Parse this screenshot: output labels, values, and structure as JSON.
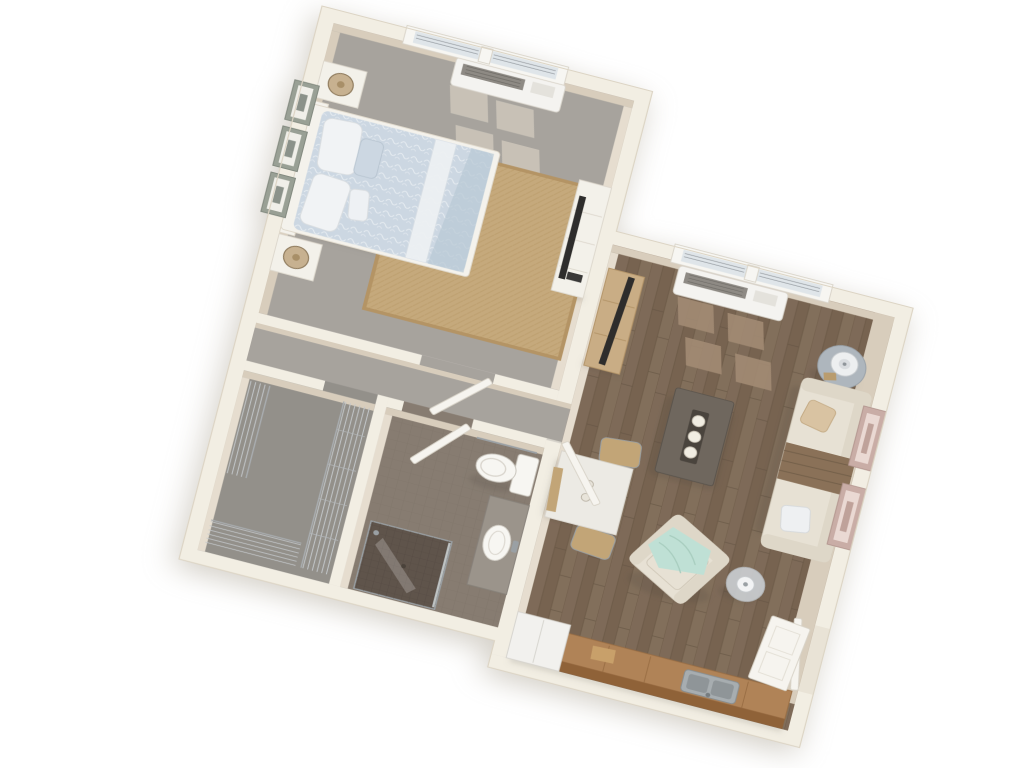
{
  "scene": {
    "description": "3D bird's-eye dollhouse rendering of a one-bedroom apartment floor plan on a white background, rotated clockwise about 15 degrees",
    "view": "top-down 3D render",
    "rotation_deg": 14.5
  },
  "colors": {
    "background": "#ffffff",
    "wall": "#f2eee3",
    "wall_outline": "#dcd4c4",
    "wall_face": "#d8cdbc",
    "wall_face_light": "#e6ddcf",
    "carpet": "#a7a39d",
    "carpet_sun": "#c9c3b8",
    "carpet_closet": "#93908a",
    "wood": "#7e6a58",
    "wood_dark": "#725e4c",
    "wood_sun": "#a28b73",
    "tile": "#877c71",
    "tile_line": "#776d62",
    "shower_tile": "#5f544b",
    "rug": "#c5a97c",
    "rug_border": "#b49465",
    "duvet": "#ccd7e2",
    "duvet_fold": "#eef1f4",
    "bedframe": "#f4f2ec",
    "pillow": "#f1f3f5",
    "nightstand": "#f3f1ea",
    "lamp_tan": "#c7b190",
    "art_frame": "#99a095",
    "art_mat": "#f0efe9",
    "art_frame_pink": "#c9ada6",
    "tv_black": "#2e2d2c",
    "console_wood": "#c9ad85",
    "side_table": "#aeb6bd",
    "lamp_shade": "#edeff0",
    "sofa": "#e7e1d4",
    "sofa_trim": "#ded7c8",
    "throw_brown": "#8a7158",
    "throw_mint": "#bfe0d5",
    "coffee_table": "#6f675e",
    "candle": "#f1ede2",
    "dining_table": "#eceae4",
    "chair_wood": "#c2a577",
    "counter_wood": "#b08357",
    "cabinet_wood": "#8f6238",
    "sink_metal": "#a7adb0",
    "appliance_white": "#f2f1ee",
    "door_white": "#f6f4ef",
    "porcelain": "#f7f6f2",
    "vanity_grey": "#9b948b",
    "chrome": "#9aa0a4"
  },
  "rooms": [
    {
      "id": "bedroom",
      "label": "Bedroom",
      "floor": "gray carpet",
      "items": [
        "queen bed with light blue patterned duvet",
        "two white nightstands with tan drum lamps",
        "three picture frames above headboard",
        "jute area rug",
        "white dresser with flat-screen TV",
        "wall air-conditioning unit under window",
        "double window with blinds",
        "door to hallway"
      ]
    },
    {
      "id": "living-room",
      "label": "Living Room",
      "floor": "brown hardwood planks",
      "items": [
        "cream sofa with brown throw and accent pillows",
        "dark gray coffee table with three candles",
        "cream armchair with mint throw",
        "oak TV console with flat-screen TV",
        "round gray side table with lamp",
        "floor lamp",
        "two picture frames on right wall",
        "double window with blinds",
        "wall air-conditioning unit",
        "white square dining table with two wooden chairs",
        "front door"
      ]
    },
    {
      "id": "kitchenette",
      "label": "Kitchenette",
      "floor": "brown hardwood planks",
      "items": [
        "wood base cabinets with countertop",
        "stainless steel sink",
        "white refrigerator"
      ]
    },
    {
      "id": "bathroom",
      "label": "Bathroom",
      "floor": "brown mosaic tile",
      "items": [
        "toilet",
        "gray vanity with white vessel sink",
        "walk-in shower with dark tile and glass panel",
        "towel bar",
        "door"
      ]
    },
    {
      "id": "closet",
      "label": "Walk-in Closet",
      "floor": "gray carpet",
      "items": [
        "chrome wire shelving along three walls"
      ]
    },
    {
      "id": "hallway",
      "label": "Hallway",
      "floor": "gray carpet",
      "items": [
        "bedroom door",
        "bathroom door",
        "open passage to living room"
      ]
    }
  ]
}
